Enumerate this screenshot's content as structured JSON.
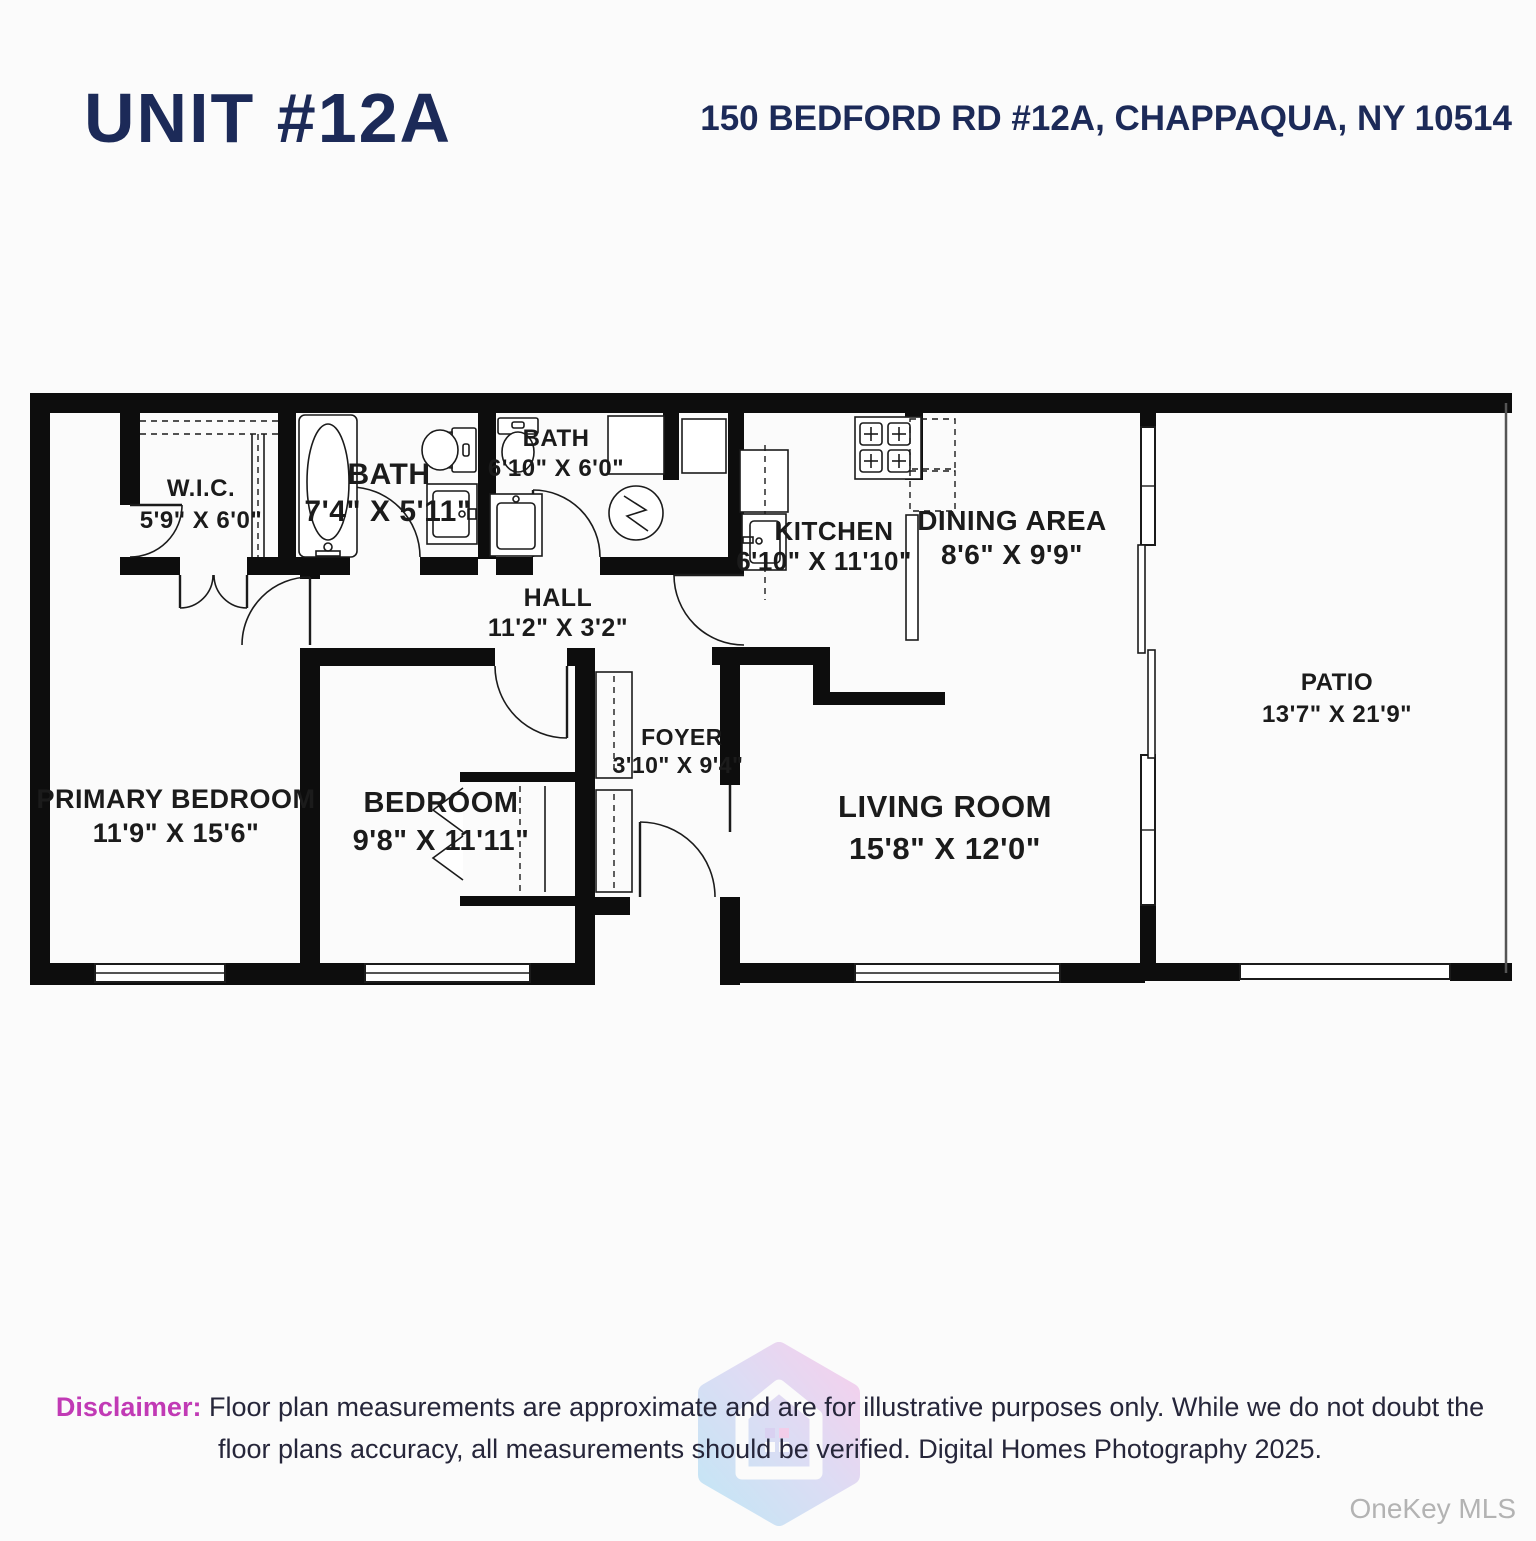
{
  "header": {
    "title": "UNIT #12A",
    "address": "150 BEDFORD RD #12A, CHAPPAQUA, NY 10514"
  },
  "rooms": {
    "wic": {
      "name": "W.I.C.",
      "dims": "5'9\" X 6'0\""
    },
    "bath1": {
      "name": "BATH",
      "dims": "7'4\" X 5'11\""
    },
    "bath2": {
      "name": "BATH",
      "dims": "6'10\" X 6'0\""
    },
    "kitchen": {
      "name": "KITCHEN",
      "dims": "6'10\" X 11'10\""
    },
    "dining": {
      "name": "DINING AREA",
      "dims": "8'6\" X 9'9\""
    },
    "patio": {
      "name": "PATIO",
      "dims": "13'7\" X 21'9\""
    },
    "hall": {
      "name": "HALL",
      "dims": "11'2\" X 3'2\""
    },
    "foyer": {
      "name": "FOYER",
      "dims": "3'10\" X 9'4\""
    },
    "primary_bedroom": {
      "name": "PRIMARY BEDROOM",
      "dims": "11'9\" X 15'6\""
    },
    "bedroom": {
      "name": "BEDROOM",
      "dims": "9'8\" X 11'11\""
    },
    "living": {
      "name": "LIVING ROOM",
      "dims": "15'8\" X 12'0\""
    }
  },
  "footer": {
    "disclaimer_label": "Disclaimer:",
    "disclaimer_line1": " Floor plan measurements are approximate and are for illustrative purposes only. While we do not doubt the",
    "disclaimer_line2": "floor plans accuracy, all measurements should be verified. Digital Homes Photography 2025.",
    "mls_watermark": "OneKey MLS"
  },
  "colors": {
    "navy": "#1c2a58",
    "magenta": "#c13ab5",
    "body_text": "#26263a",
    "wall": "#0d0d0d",
    "mls_gray": "#b3b3b3",
    "logo_blue": "#8ed2f0",
    "logo_pink": "#f0a6e0"
  }
}
